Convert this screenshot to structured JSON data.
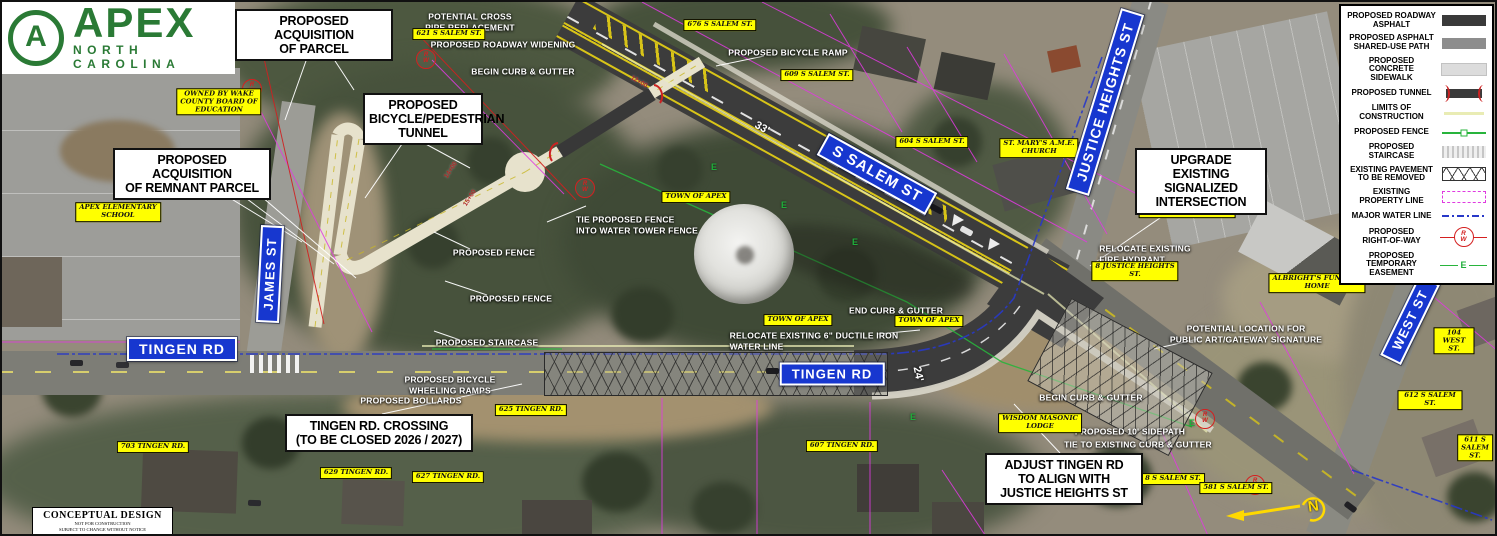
{
  "logo": {
    "monogram": "A",
    "title": "APEX",
    "subtitle": "NORTH CAROLINA"
  },
  "titleblock": {
    "l1": "CONCEPTUAL DESIGN",
    "l2": "NOT FOR CONSTRUCTION",
    "l3": "SUBJECT TO CHANGE WITHOUT NOTICE"
  },
  "compass": {
    "n": "N"
  },
  "symbols": {
    "rw": "R/W",
    "easement": "E"
  },
  "colors": {
    "sign_blue": "#1737cf",
    "label_yellow": "#ffff00",
    "row_red": "#d42020",
    "easement_green": "#1fae3a",
    "property_magenta": "#e03ae0",
    "water_blue": "#2838c8",
    "apex_green": "#2a7a35",
    "asphalt": "#3c3c3c"
  },
  "legend": {
    "items": [
      {
        "id": "roadway-asphalt",
        "label": "PROPOSED ROADWAY\nASPHALT"
      },
      {
        "id": "asphalt-shared-use-path",
        "label": "PROPOSED ASPHALT\nSHARED-USE PATH"
      },
      {
        "id": "concrete-sidewalk",
        "label": "PROPOSED CONCRETE\nSIDEWALK"
      },
      {
        "id": "tunnel",
        "label": "PROPOSED TUNNEL"
      },
      {
        "id": "limits-of-construction",
        "label": "LIMITS OF\nCONSTRUCTION"
      },
      {
        "id": "fence",
        "label": "PROPOSED FENCE"
      },
      {
        "id": "staircase",
        "label": "PROPOSED STAIRCASE"
      },
      {
        "id": "pavement-removed",
        "label": "EXISTING PAVEMENT\nTO BE REMOVED"
      },
      {
        "id": "property-line",
        "label": "EXISTING\nPROPERTY LINE"
      },
      {
        "id": "water-line",
        "label": "MAJOR WATER LINE"
      },
      {
        "id": "right-of-way",
        "label": "PROPOSED\nRIGHT-OF-WAY"
      },
      {
        "id": "temporary-easement",
        "label": "PROPOSED TEMPORARY\nEASEMENT"
      }
    ]
  },
  "street_signs": [
    {
      "id": "s-salem-st",
      "text": "S SALEM ST",
      "x": 875,
      "y": 172,
      "rot": 29,
      "fs": 15
    },
    {
      "id": "justice-heights-st",
      "text": "JUSTICE HEIGHTS ST",
      "x": 1103,
      "y": 100,
      "rot": -73,
      "fs": 14
    },
    {
      "id": "james-st",
      "text": "JAMES ST",
      "x": 268,
      "y": 272,
      "rot": -87,
      "fs": 13
    },
    {
      "id": "tingen-rd-west",
      "text": "TINGEN RD",
      "x": 180,
      "y": 347,
      "rot": 0,
      "fs": 14
    },
    {
      "id": "tingen-rd-center",
      "text": "TINGEN RD",
      "x": 830,
      "y": 372,
      "rot": 0,
      "fs": 13
    },
    {
      "id": "west-st",
      "text": "WEST ST",
      "x": 1408,
      "y": 318,
      "rot": -64,
      "fs": 13
    }
  ],
  "callouts": [
    {
      "id": "acquisition-of-parcel",
      "text": "PROPOSED  ACQUISITION\nOF  PARCEL",
      "x": 233,
      "y": 7,
      "w": 158
    },
    {
      "id": "bicycle-pedestrian-tunnel",
      "text": "PROPOSED\nBICYCLE/PEDESTRIAN\nTUNNEL",
      "x": 361,
      "y": 91,
      "w": 120
    },
    {
      "id": "acquisition-of-remnant-parcel",
      "text": "PROPOSED  ACQUISITION\nOF  REMNANT  PARCEL",
      "x": 111,
      "y": 146,
      "w": 158
    },
    {
      "id": "upgrade-signalized-intersection",
      "text": "UPGRADE  EXISTING\nSIGNALIZED\nINTERSECTION",
      "x": 1133,
      "y": 146,
      "w": 132
    },
    {
      "id": "tingen-rd-crossing",
      "text": "TINGEN  RD.  CROSSING\n(TO  BE  CLOSED  2026 / 2027)",
      "x": 283,
      "y": 412,
      "w": 188
    },
    {
      "id": "adjust-tingen-rd",
      "text": "ADJUST  TINGEN  RD\nTO  ALIGN  WITH\nJUSTICE  HEIGHTS  ST",
      "x": 983,
      "y": 451,
      "w": 158
    }
  ],
  "notes": [
    {
      "text": "POTENTIAL CROSS\nPIPE REPLACEMENT",
      "x": 468,
      "y": 20
    },
    {
      "text": "PROPOSED RETAINING WALLS",
      "x": 306,
      "y": 43
    },
    {
      "text": "PROPOSED ROADWAY WIDENING",
      "x": 501,
      "y": 43
    },
    {
      "text": "BEGIN CURB & GUTTER",
      "x": 521,
      "y": 70
    },
    {
      "text": "PROPOSED BICYCLE RAMP",
      "x": 786,
      "y": 51
    },
    {
      "text": "TIE PROPOSED FENCE\nINTO WATER TOWER FENCE",
      "x": 635,
      "y": 223,
      "ta": "left"
    },
    {
      "text": "PROPOSED FENCE",
      "x": 492,
      "y": 251
    },
    {
      "text": "PROPOSED FENCE",
      "x": 509,
      "y": 297
    },
    {
      "text": "PROPOSED STAIRCASE",
      "x": 485,
      "y": 341
    },
    {
      "text": "PROPOSED BICYCLE\nWHEELING RAMPS",
      "x": 448,
      "y": 383
    },
    {
      "text": "PROPOSED BOLLARDS",
      "x": 409,
      "y": 399
    },
    {
      "text": "END CURB & GUTTER",
      "x": 894,
      "y": 309
    },
    {
      "text": "RELOCATE EXISTING 6\" DUCTILE IRON\nWATER LINE",
      "x": 812,
      "y": 339,
      "ta": "left"
    },
    {
      "text": "RELOCATE EXISTING\nFIRE HYDRANT",
      "x": 1143,
      "y": 252,
      "ta": "left"
    },
    {
      "text": "POTENTIAL LOCATION FOR\nPUBLIC ART/GATEWAY SIGNATURE",
      "x": 1244,
      "y": 332
    },
    {
      "text": "BEGIN CURB & GUTTER",
      "x": 1089,
      "y": 396
    },
    {
      "text": "PROPOSED 10' SIDEPATH",
      "x": 1128,
      "y": 430
    },
    {
      "text": "TIE TO EXISTING CURB & GUTTER",
      "x": 1136,
      "y": 443
    }
  ],
  "parcel_labels": [
    {
      "text": "676 S SALEM ST.",
      "x": 718,
      "y": 23
    },
    {
      "text": "621 S SALEM ST.",
      "x": 447,
      "y": 32
    },
    {
      "text": "609 S SALEM ST.",
      "x": 815,
      "y": 73
    },
    {
      "text": "604 S SALEM ST.",
      "x": 930,
      "y": 140
    },
    {
      "text": "OWNED BY WAKE\nCOUNTY BOARD OF\nEDUCATION",
      "x": 217,
      "y": 100
    },
    {
      "text": "APEX ELEMENTARY\nSCHOOL",
      "x": 116,
      "y": 210
    },
    {
      "text": "ST. MARY'S A.M.E.\nCHURCH",
      "x": 1037,
      "y": 146
    },
    {
      "text": "101 JUSTICE HEIGHTS\nST.",
      "x": 1185,
      "y": 206
    },
    {
      "text": "8 JUSTICE HEIGHTS\nST.",
      "x": 1133,
      "y": 269
    },
    {
      "text": "ALBRIGHT'S FUNERAL\nHOME",
      "x": 1315,
      "y": 281
    },
    {
      "text": "TOWN OF APEX",
      "x": 694,
      "y": 195
    },
    {
      "text": "TOWN OF APEX",
      "x": 796,
      "y": 318
    },
    {
      "text": "TOWN OF APEX",
      "x": 927,
      "y": 319
    },
    {
      "text": "625 TINGEN RD.",
      "x": 529,
      "y": 408
    },
    {
      "text": "703 TINGEN RD.",
      "x": 151,
      "y": 445
    },
    {
      "text": "629 TINGEN RD.",
      "x": 354,
      "y": 471
    },
    {
      "text": "627 TINGEN RD.",
      "x": 446,
      "y": 475
    },
    {
      "text": "607 TINGEN RD.",
      "x": 840,
      "y": 444
    },
    {
      "text": "WISDOM MASONIC\nLODGE",
      "x": 1038,
      "y": 421
    },
    {
      "text": "8 S SALEM ST.",
      "x": 1171,
      "y": 477
    },
    {
      "text": "581 S SALEM ST.",
      "x": 1234,
      "y": 486
    },
    {
      "text": "104 WEST ST.",
      "x": 1452,
      "y": 339
    },
    {
      "text": "612 S SALEM ST.",
      "x": 1428,
      "y": 398
    },
    {
      "text": "611 S SALEM ST.",
      "x": 1473,
      "y": 446
    }
  ],
  "dimensions": [
    {
      "text": "33'",
      "x": 760,
      "y": 126,
      "rot": 29
    },
    {
      "text": "24'",
      "x": 916,
      "y": 372,
      "rot": 78
    }
  ],
  "stations": [
    {
      "text": "12+00",
      "x": 637,
      "y": 80,
      "rot": 30
    },
    {
      "text": "14+00",
      "x": 449,
      "y": 168,
      "rot": -57
    },
    {
      "text": "15+00",
      "x": 468,
      "y": 196,
      "rot": -57
    }
  ],
  "rw_symbols": [
    {
      "x": 250,
      "y": 87
    },
    {
      "x": 424,
      "y": 57
    },
    {
      "x": 583,
      "y": 186
    },
    {
      "x": 1203,
      "y": 417
    },
    {
      "x": 1253,
      "y": 483
    }
  ],
  "easement_marks": [
    {
      "x": 712,
      "y": 165
    },
    {
      "x": 782,
      "y": 203
    },
    {
      "x": 853,
      "y": 240
    },
    {
      "x": 911,
      "y": 415
    },
    {
      "x": 1190,
      "y": 421
    }
  ]
}
